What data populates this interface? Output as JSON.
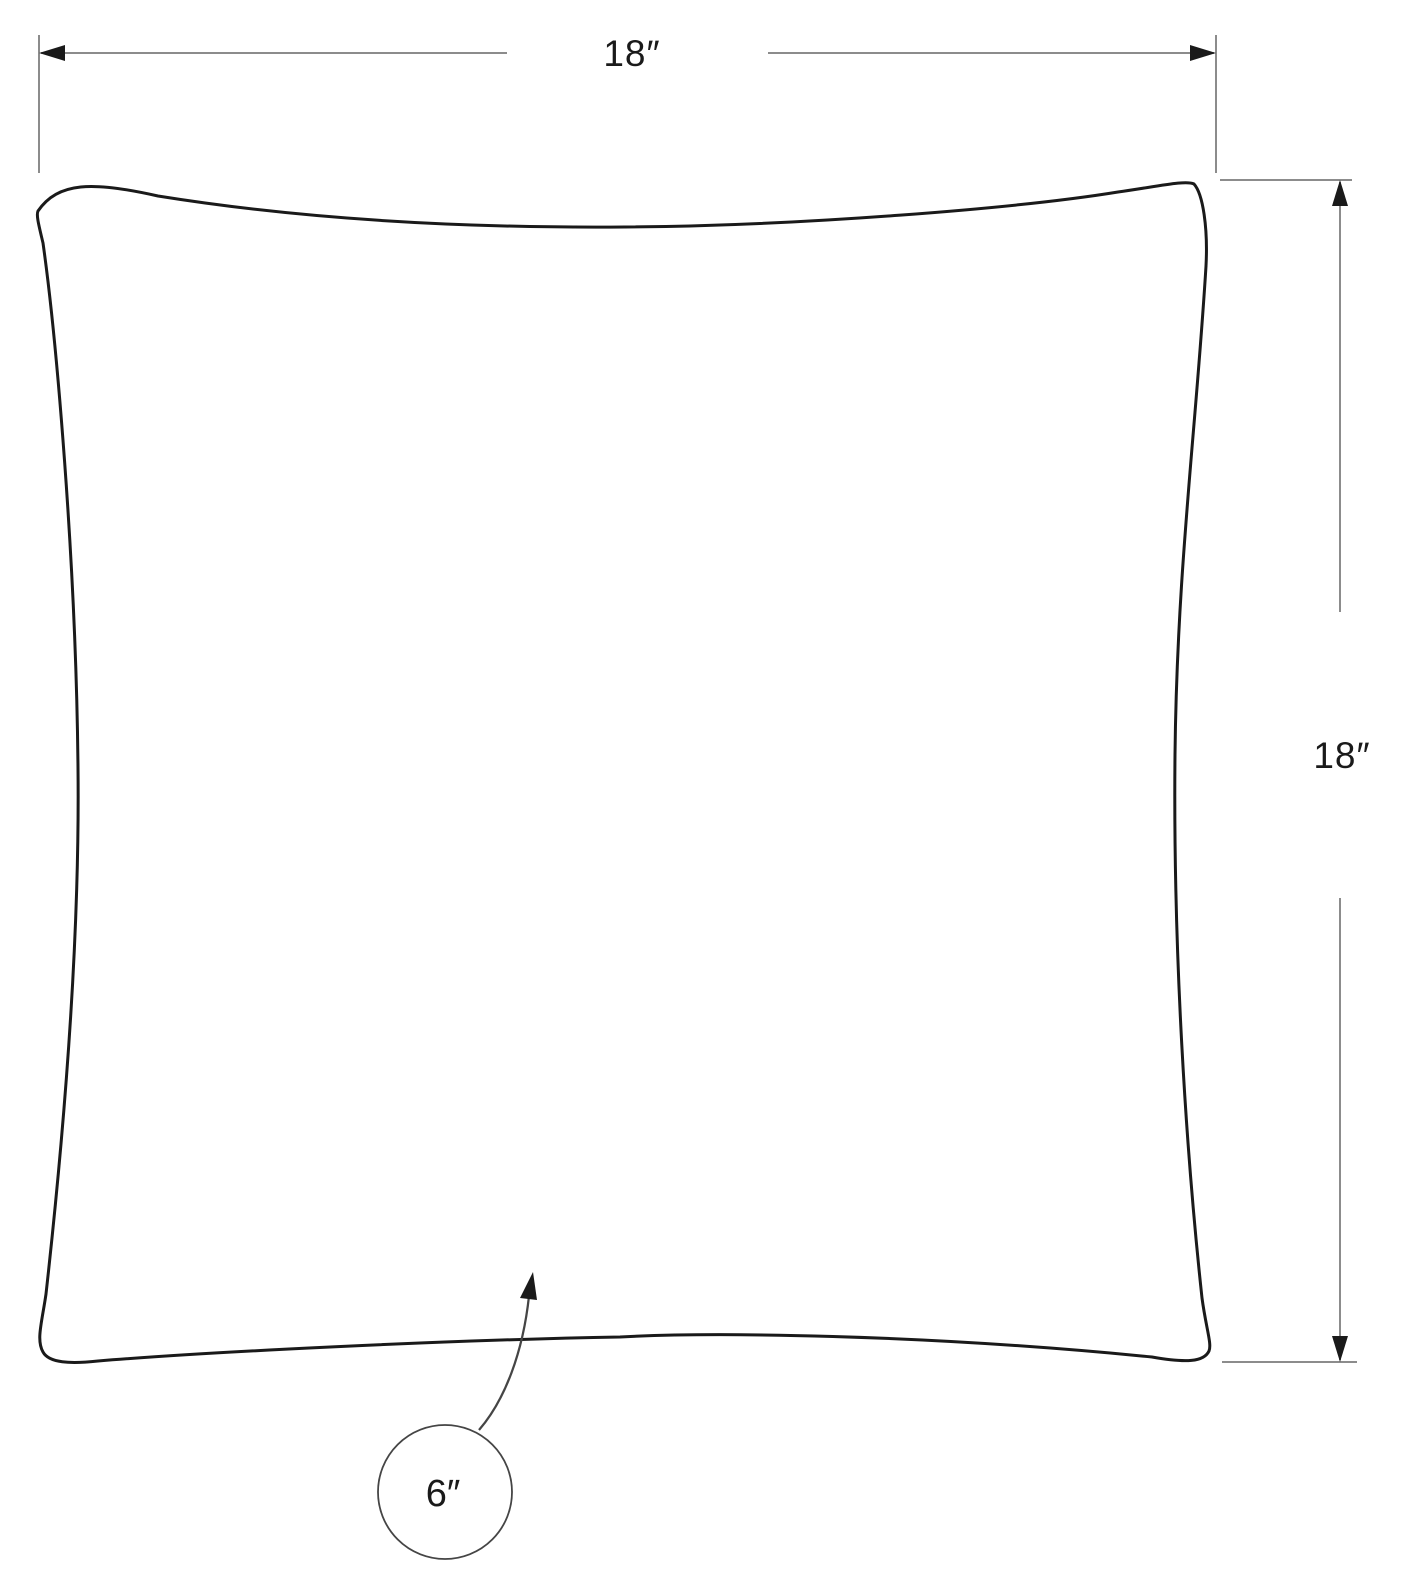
{
  "diagram": {
    "subject": "pillow-dimension-drawing",
    "dimensions": {
      "width": {
        "label": "18″",
        "value_inches": 18
      },
      "height": {
        "label": "18″",
        "value_inches": 18
      },
      "thickness": {
        "label": "6″",
        "value_inches": 6
      }
    },
    "colors": {
      "background": "#ffffff",
      "outline": "#1a1a1a",
      "dimension_line": "#8c8c8c",
      "arrow": "#1a1a1a",
      "text": "#1a1a1a",
      "callout": "#454545"
    }
  }
}
